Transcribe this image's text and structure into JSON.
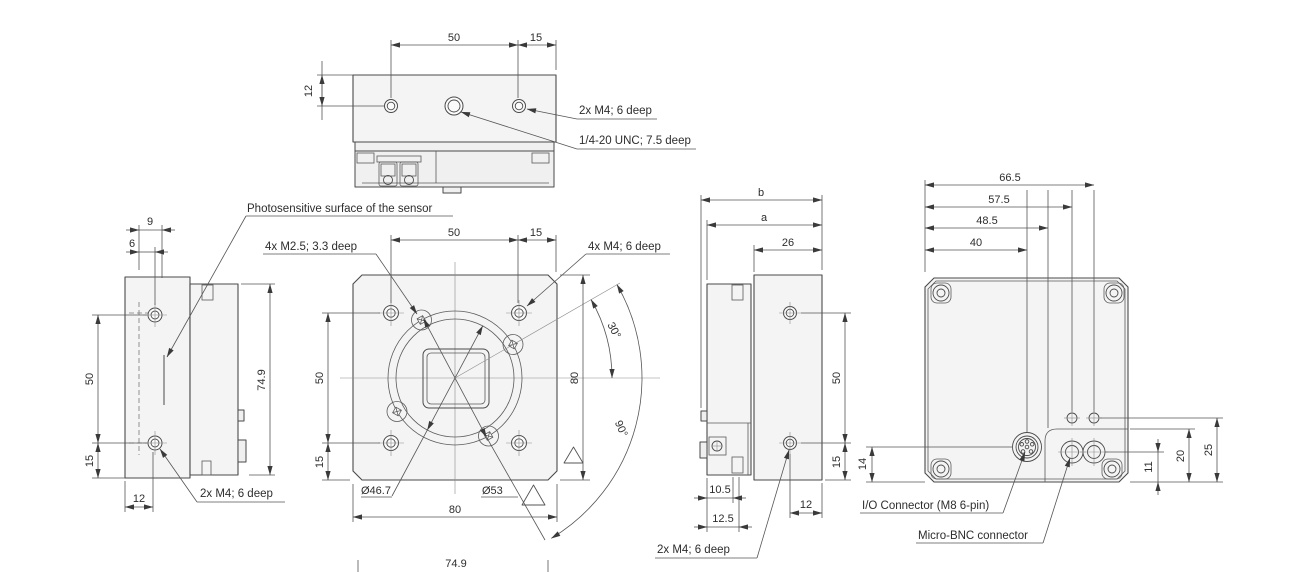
{
  "views": {
    "top": {
      "d50": "50",
      "d15": "15",
      "d12": "12",
      "label_m4": "2x M4; 6 deep",
      "label_unc": "1/4-20 UNC; 7.5 deep"
    },
    "left_side": {
      "d9": "9",
      "d6": "6",
      "d50": "50",
      "d15": "15",
      "d12": "12",
      "d74_9": "74.9",
      "label_photosensitive": "Photosensitive surface of the sensor",
      "label_m4": "2x M4; 6 deep"
    },
    "front": {
      "top_50": "50",
      "top_15": "15",
      "left_50": "50",
      "left_15": "15",
      "right_80": "80",
      "bottom_80": "80",
      "bottom_74_9": "74.9",
      "dia_46_7": "Ø46.7",
      "dia_53": "Ø53",
      "angle_30": "30°",
      "angle_90": "90°",
      "label_m25": "4x M2.5; 3.3 deep",
      "label_m4": "4x M4; 6 deep"
    },
    "right_side": {
      "b": "b",
      "a": "a",
      "d26": "26",
      "d50": "50",
      "d15": "15",
      "d10_5": "10.5",
      "d12_5": "12.5",
      "d12": "12",
      "label_m4": "2x M4; 6 deep"
    },
    "back": {
      "d66_5": "66.5",
      "d57_5": "57.5",
      "d48_5": "48.5",
      "d40": "40",
      "d14": "14",
      "d11": "11",
      "d20": "20",
      "d25": "25",
      "label_io": "I/O Connector (M8 6-pin)",
      "label_bnc": "Micro-BNC connector"
    }
  },
  "colors": {
    "outline": "#4a4a4a",
    "dimension": "#555555",
    "body_fill": "#f4f4f4",
    "text": "#2d2d2d",
    "background": "#ffffff"
  }
}
